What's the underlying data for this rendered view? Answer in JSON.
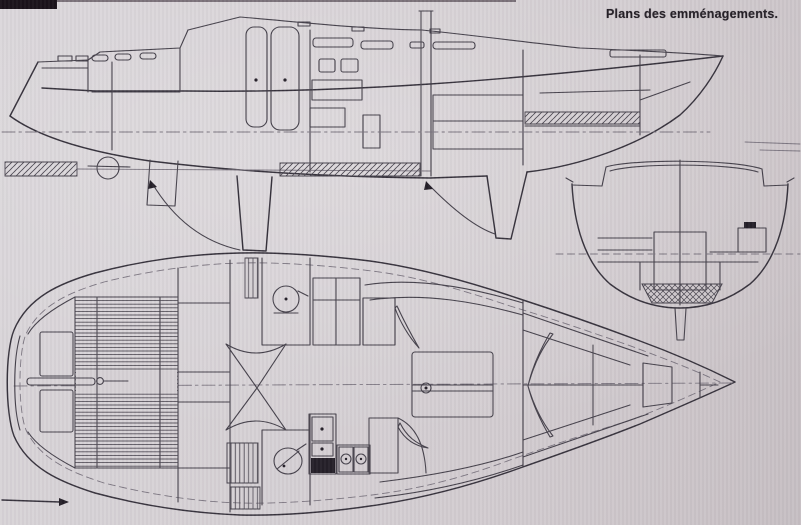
{
  "page": {
    "title": "Plans des emménagements.",
    "colors": {
      "paper": "#d6d1d5",
      "ink": "#45414b",
      "ink-dark": "#36323c",
      "ink-light": "#7b7580",
      "page_edge": "#4e3b2e"
    }
  }
}
